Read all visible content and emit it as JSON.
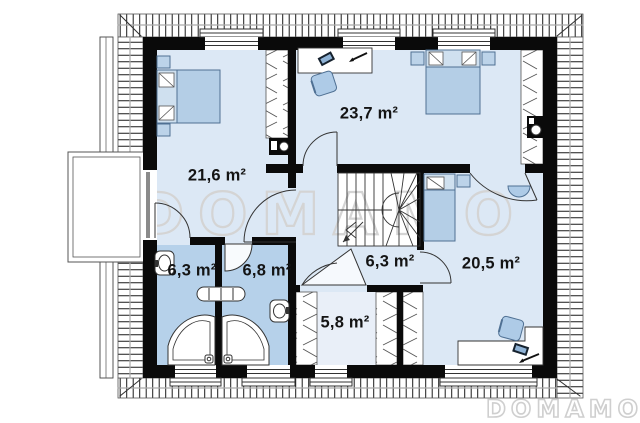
{
  "plan": {
    "title": "attic floor plan",
    "rooms": [
      {
        "id": "bedroom-1",
        "area": "21,6 m²"
      },
      {
        "id": "bedroom-2",
        "area": "23,7 m²"
      },
      {
        "id": "bathroom-1",
        "area": "6,3 m²"
      },
      {
        "id": "bathroom-2",
        "area": "6,8 m²"
      },
      {
        "id": "hall",
        "area": "6,3 m²"
      },
      {
        "id": "wardrobe",
        "area": "5,8 m²"
      },
      {
        "id": "bedroom-3",
        "area": "20,5 m²"
      }
    ],
    "watermark": {
      "center": "DOMAMO",
      "bottom_right": "DOMAMO"
    },
    "colors": {
      "wall": "#0a0a0a",
      "floor": "#dce8f5",
      "floor_light": "#e9eff8",
      "bathroom": "#b6d1ea",
      "furniture": "#b4cee6",
      "furniture_stroke": "#4f7093",
      "watermark_outline": "#d4d4d4"
    }
  }
}
